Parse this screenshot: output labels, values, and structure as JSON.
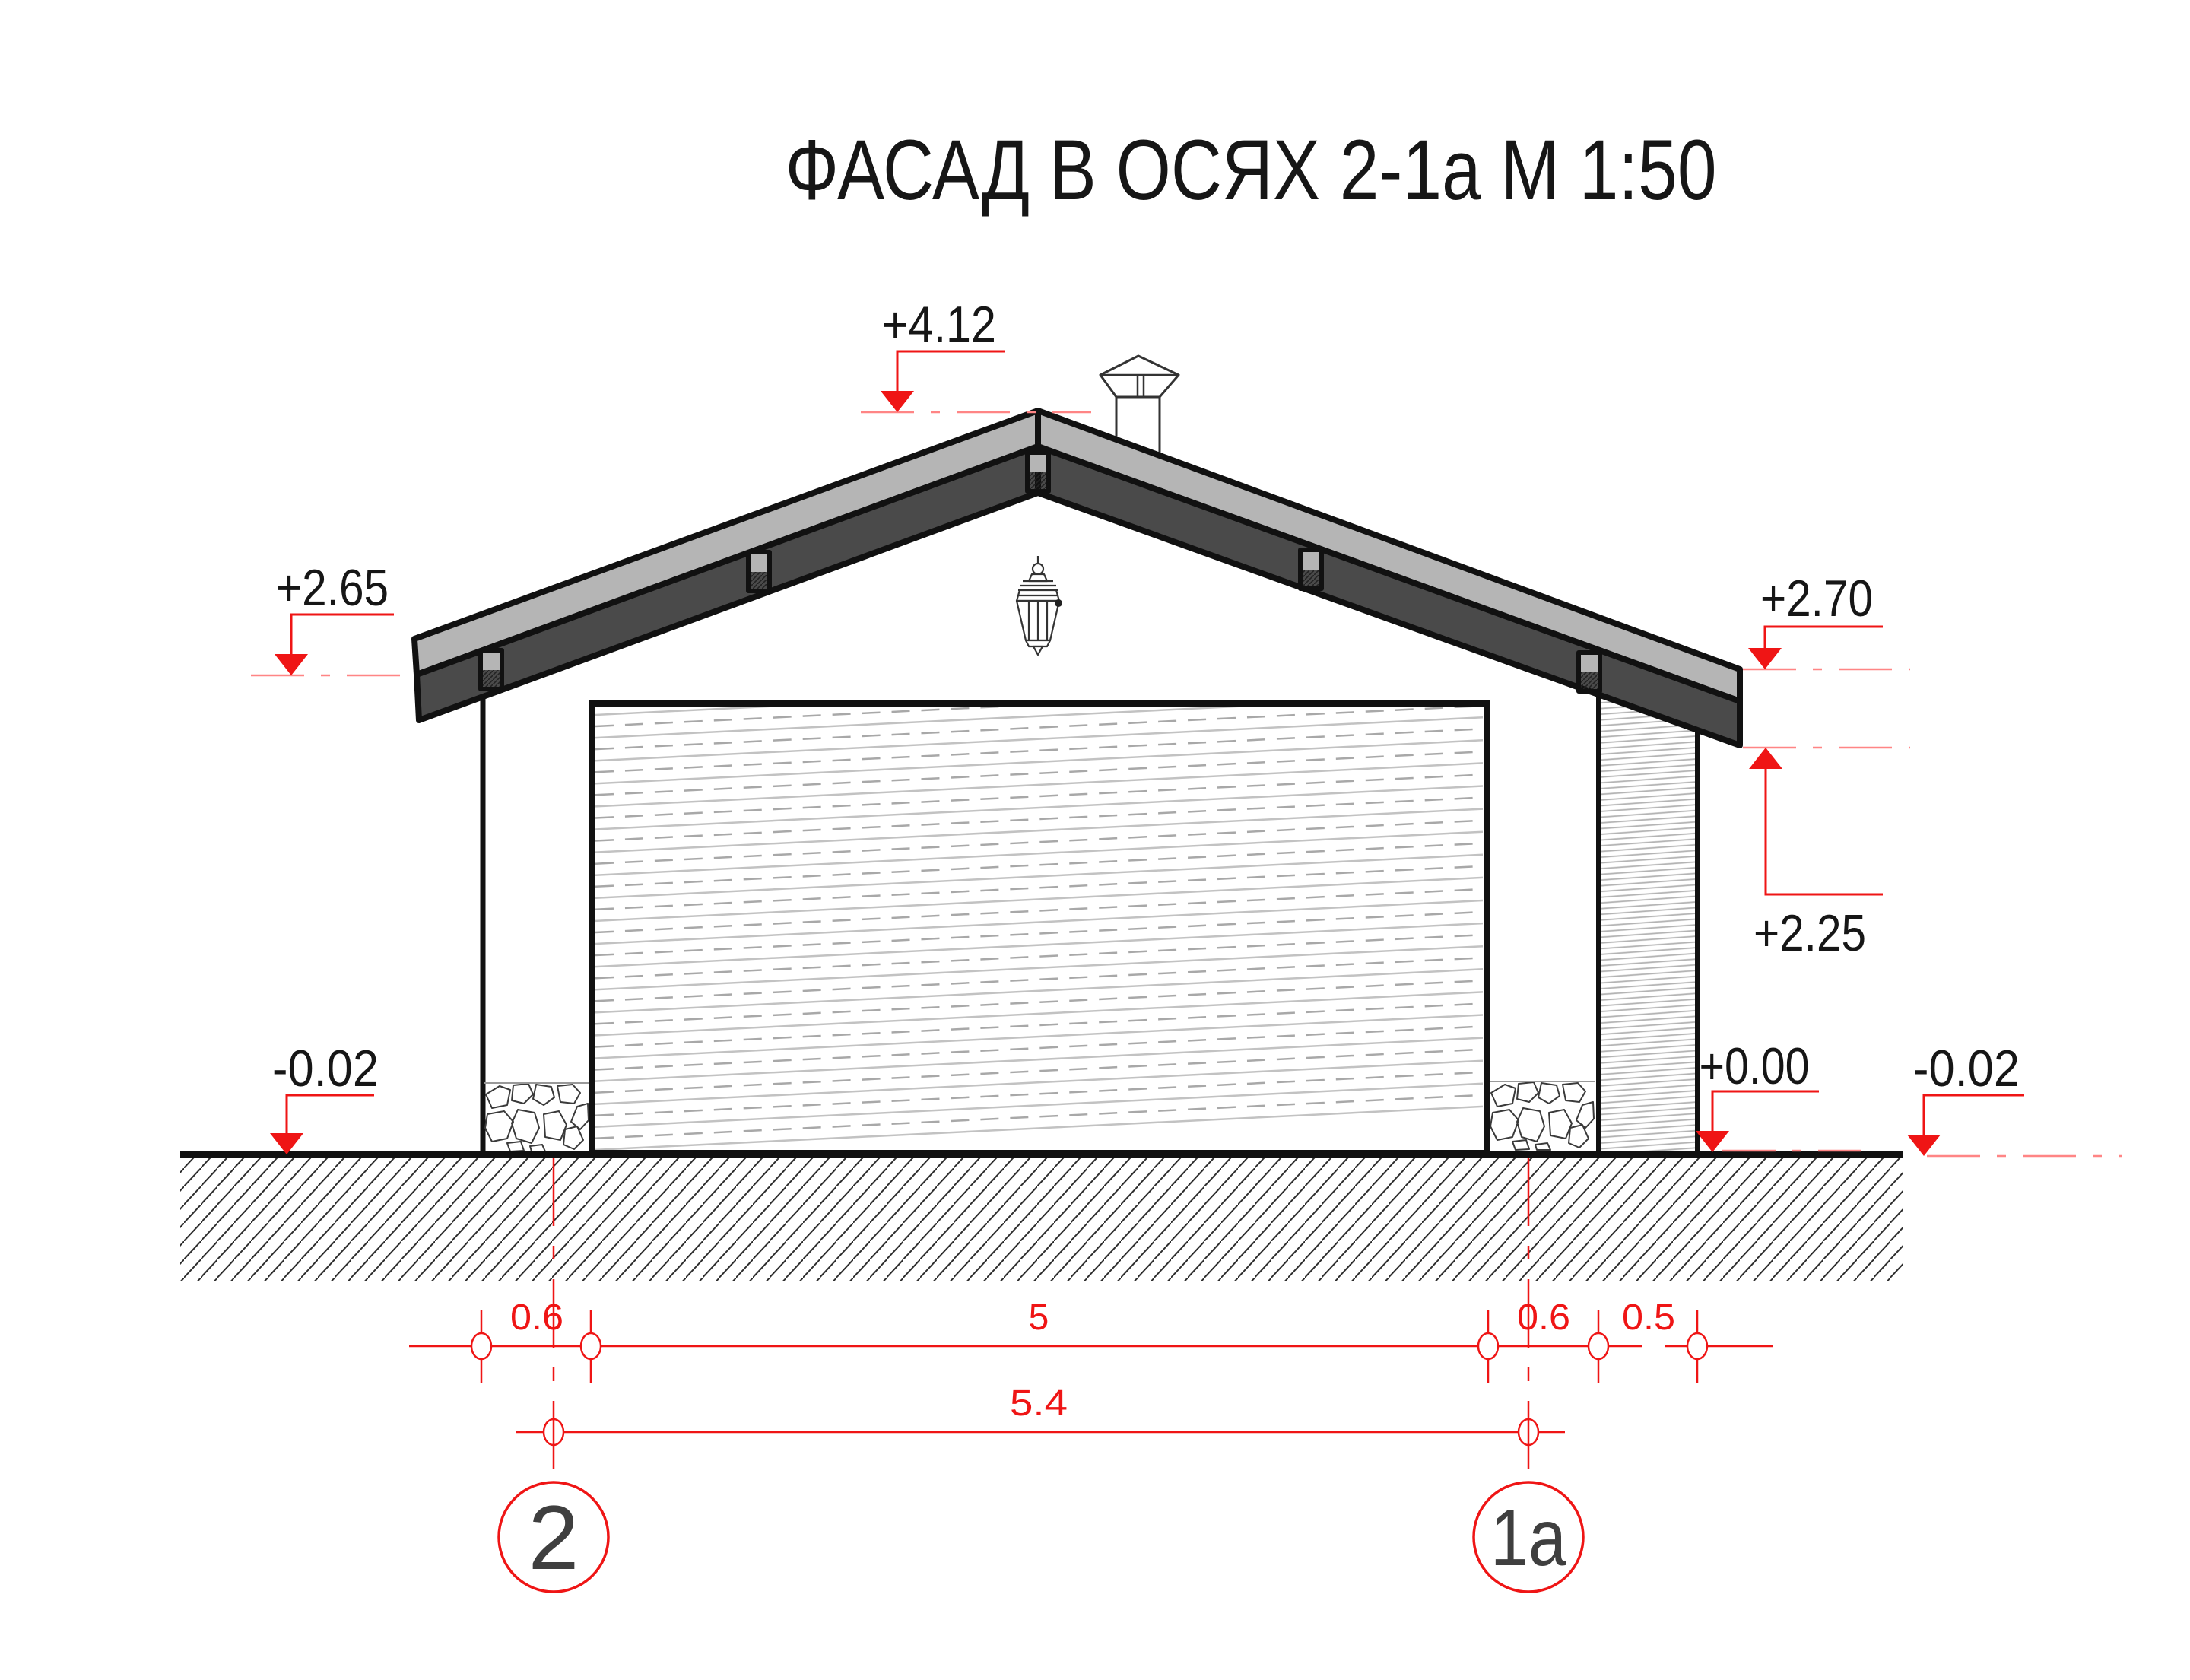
{
  "title": "ФАСАД В ОСЯХ 2-1а М 1:50",
  "levels": {
    "ridge": "+4.12",
    "eave_left": "+2.65",
    "roof_top_right": "+2.70",
    "soffit_right": "+2.25",
    "ground_left": "-0.02",
    "floor": "+0.00",
    "ground_right": "-0.02"
  },
  "dimensions": {
    "row1": [
      "0.6",
      "5",
      "0.6",
      "0.5"
    ],
    "row2": [
      "5.4"
    ]
  },
  "axes": [
    {
      "label": "2"
    },
    {
      "label": "1а"
    }
  ],
  "colors": {
    "red": "#ef1515",
    "red_light": "#ff8585",
    "roof_light": "#b5b5b5",
    "roof_dark": "#4a4a4a",
    "ink": "#161616",
    "axis_ink": "#3f3f3f"
  }
}
